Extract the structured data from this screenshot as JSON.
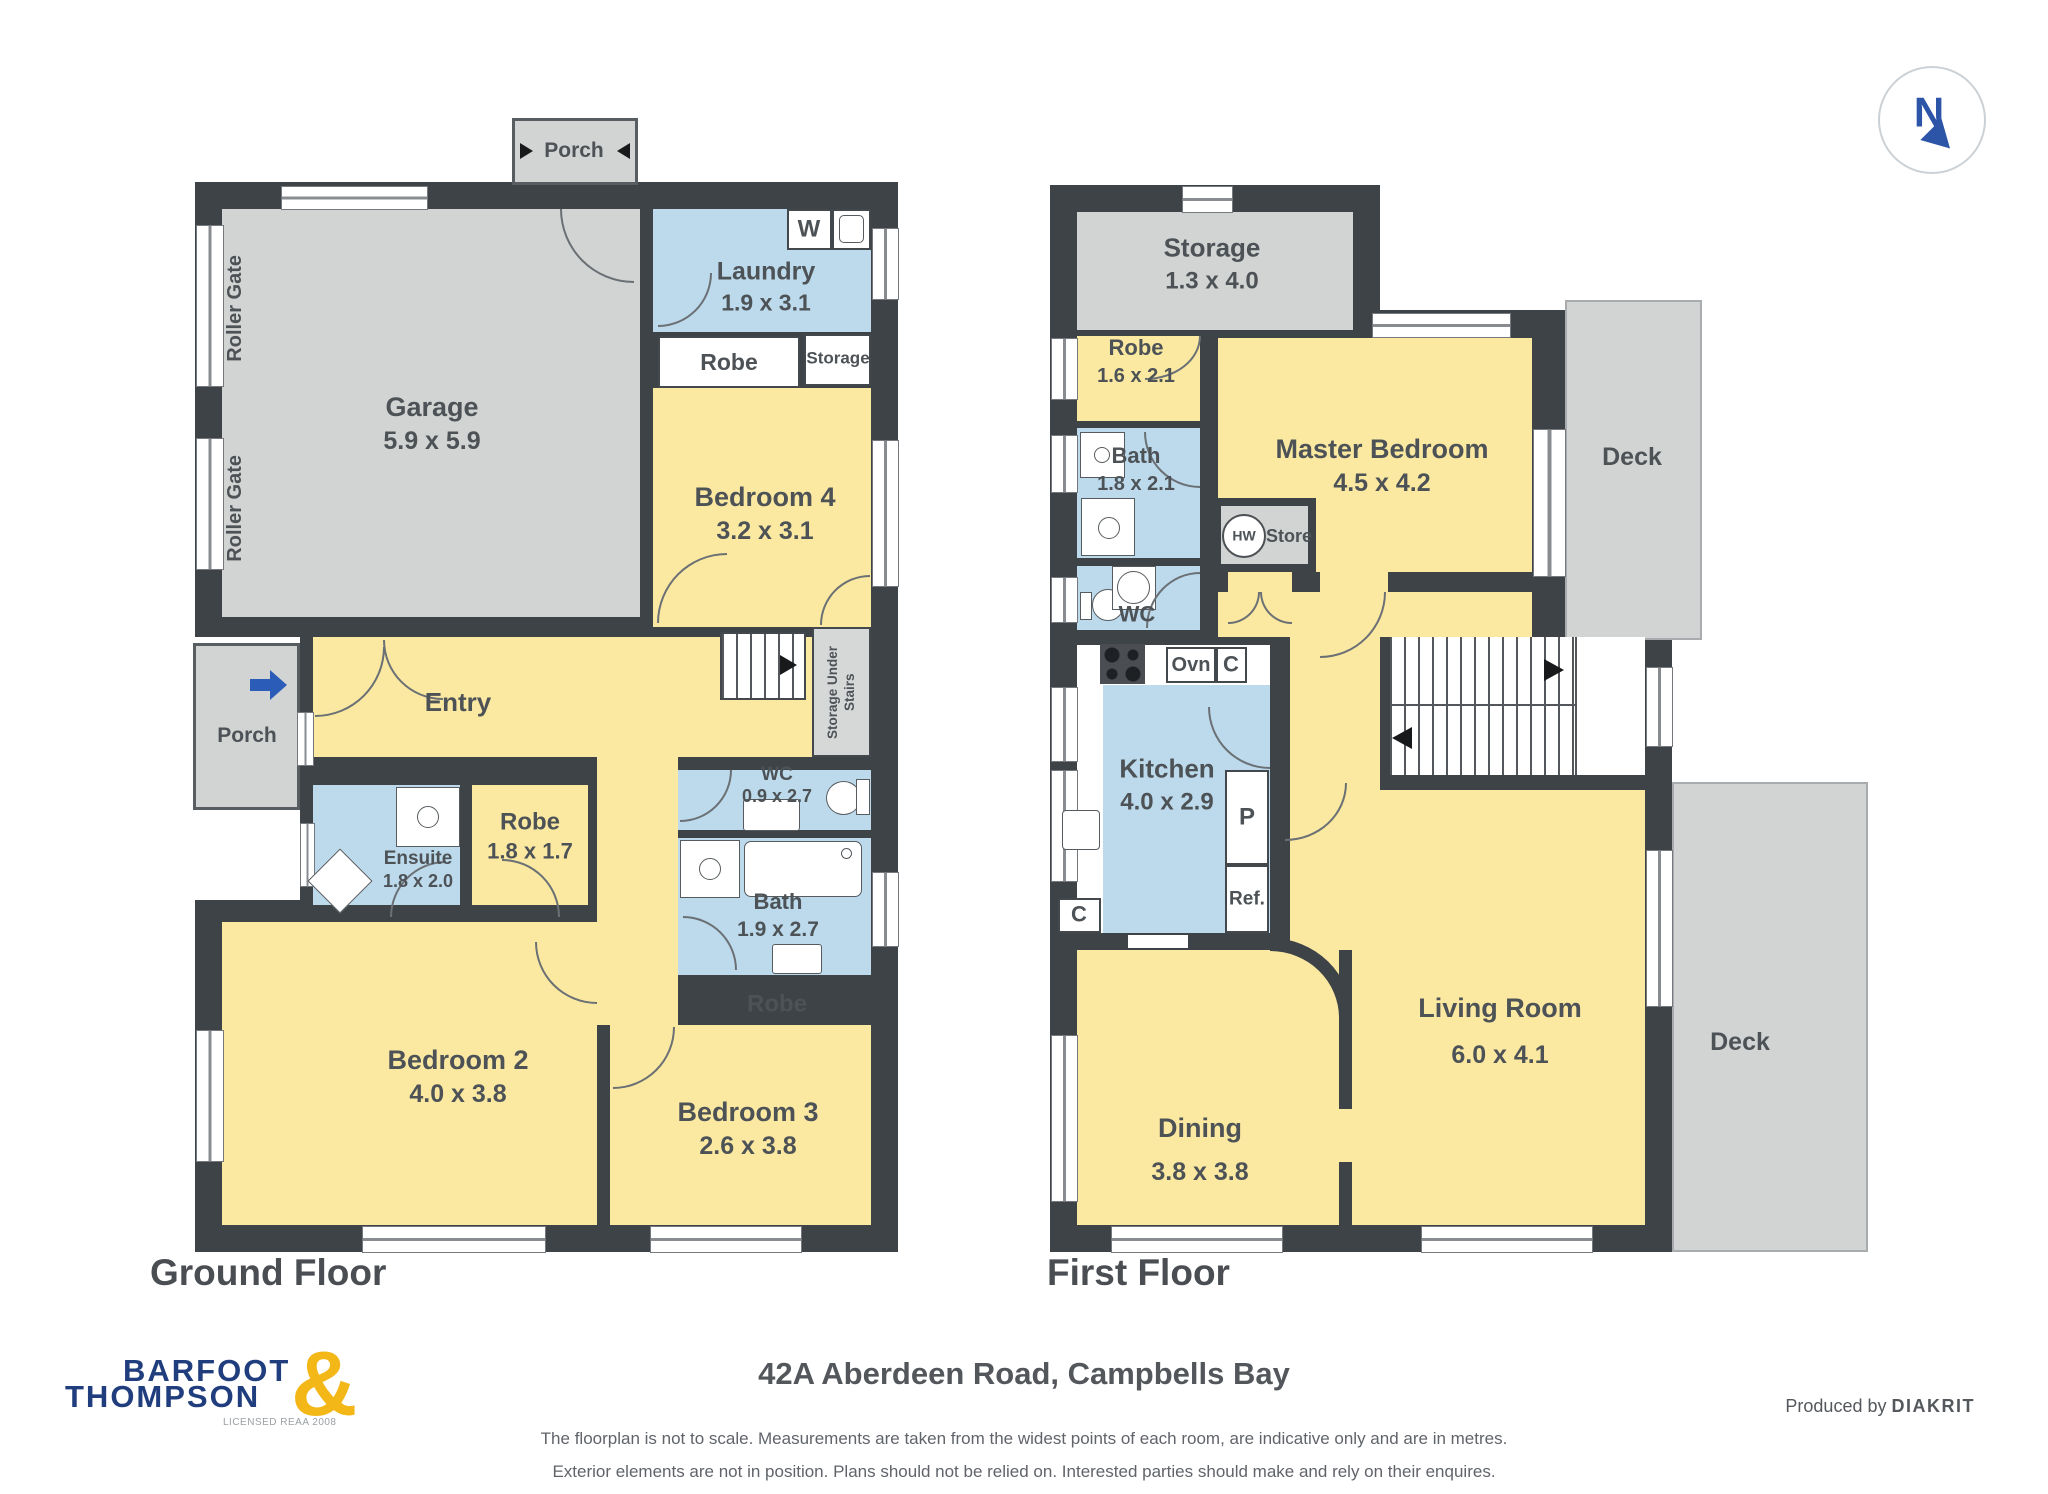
{
  "compass": {
    "north": "N"
  },
  "gf": {
    "title": "Ground Floor",
    "porch_top": "Porch",
    "porch_left": "Porch",
    "roller_gate_1": "Roller Gate",
    "roller_gate_2": "Roller Gate",
    "garage": {
      "name": "Garage",
      "dims": "5.9 x 5.9"
    },
    "laundry": {
      "name": "Laundry",
      "dims": "1.9 x 3.1"
    },
    "washer": "W",
    "robe_top": "Robe",
    "storage_top": "Storage",
    "bedroom4": {
      "name": "Bedroom 4",
      "dims": "3.2 x 3.1"
    },
    "storage_under_stairs": "Storage Under Stairs",
    "entry": "Entry",
    "wc": {
      "name": "WC",
      "dims": "0.9 x 2.7"
    },
    "bath": {
      "name": "Bath",
      "dims": "1.9 x 2.7"
    },
    "ensuite": {
      "name": "Ensuite",
      "dims": "1.8 x 2.0"
    },
    "robe2": {
      "name": "Robe",
      "dims": "1.8 x 1.7"
    },
    "robe3": "Robe",
    "bedroom2": {
      "name": "Bedroom 2",
      "dims": "4.0 x 3.8"
    },
    "bedroom3": {
      "name": "Bedroom 3",
      "dims": "2.6 x 3.8"
    }
  },
  "ff": {
    "title": "First Floor",
    "storage": {
      "name": "Storage",
      "dims": "1.3 x 4.0"
    },
    "robe": {
      "name": "Robe",
      "dims": "1.6 x 2.1"
    },
    "master": {
      "name": "Master Bedroom",
      "dims": "4.5 x 4.2"
    },
    "bath": {
      "name": "Bath",
      "dims": "1.8 x 2.1"
    },
    "wc": "WC",
    "hw": "HW",
    "store": "Store",
    "ovn": "Ovn",
    "cab_top": "C",
    "cab_left": "C",
    "kitchen": {
      "name": "Kitchen",
      "dims": "4.0 x 2.9"
    },
    "pantry": "P",
    "fridge": "Ref.",
    "deck_upper": "Deck",
    "deck_lower": "Deck",
    "dining": {
      "name": "Dining",
      "dims": "3.8 x 3.8"
    },
    "living": {
      "name": "Living Room",
      "dims": "6.0 x 4.1"
    }
  },
  "footer": {
    "brand_line1": "BARFOOT",
    "brand_amp": "&",
    "brand_line2": "THOMPSON",
    "brand_license": "LICENSED REAA 2008",
    "address": "42A Aberdeen Road, Campbells Bay",
    "disclaimer_line1": "The floorplan is not to scale. Measurements are taken from the widest points of each room, are indicative only and are in metres.",
    "disclaimer_line2": "Exterior elements are not in position. Plans should not be relied on. Interested parties should make and rely on their enquires.",
    "produced_by": "Produced by",
    "producer": "DIAKRIT"
  },
  "colors": {
    "wall": "#3e4347",
    "room_yellow": "#fbe9a2",
    "room_blue": "#bcdaeb",
    "room_gray": "#d2d4d4",
    "label_text": "#4d5256",
    "brand_navy": "#203d7d",
    "brand_gold": "#f3b718",
    "entry_arrow_blue": "#2b5cb8"
  }
}
